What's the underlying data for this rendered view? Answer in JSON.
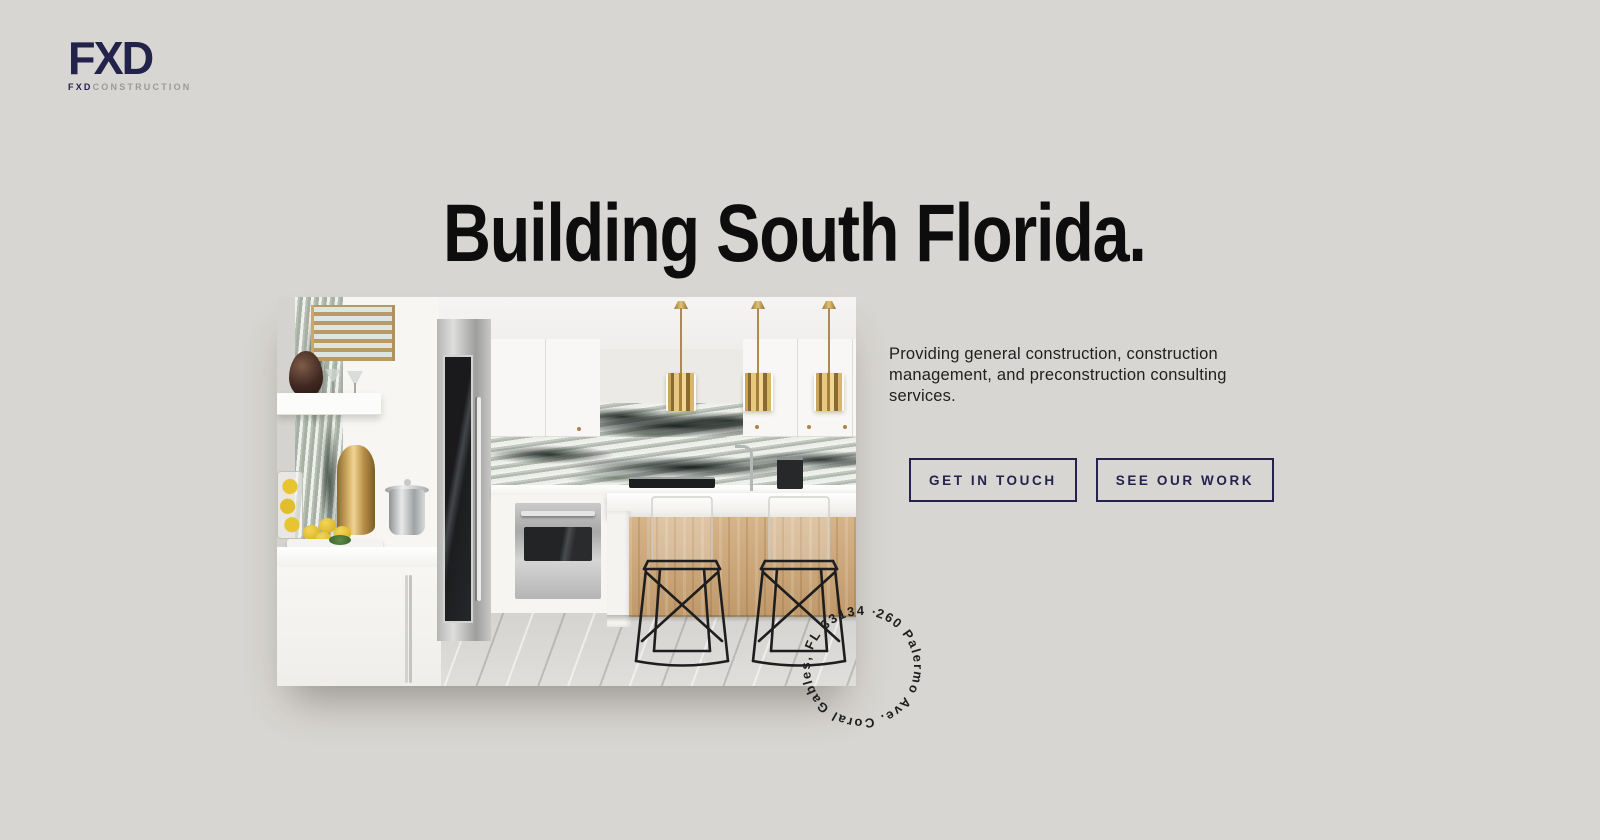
{
  "page": {
    "background": "#d8d6d2"
  },
  "logo": {
    "mark": "FXD",
    "sub_bold": "FXD",
    "sub_light": "CONSTRUCTION"
  },
  "hero": {
    "title": "Building South Florida.",
    "description": "Providing general construction, construction management, and preconstruction consulting services.",
    "cta_primary": "GET IN TOUCH",
    "cta_secondary": "SEE OUR WORK"
  },
  "address_badge": {
    "text": "260 Palermo Ave. Coral Gables, FL 33134 · "
  },
  "colors": {
    "navy": "#24234d",
    "heading": "#0d0d0d",
    "body_text": "#1f1f1f",
    "brass": "#b58a3e"
  }
}
